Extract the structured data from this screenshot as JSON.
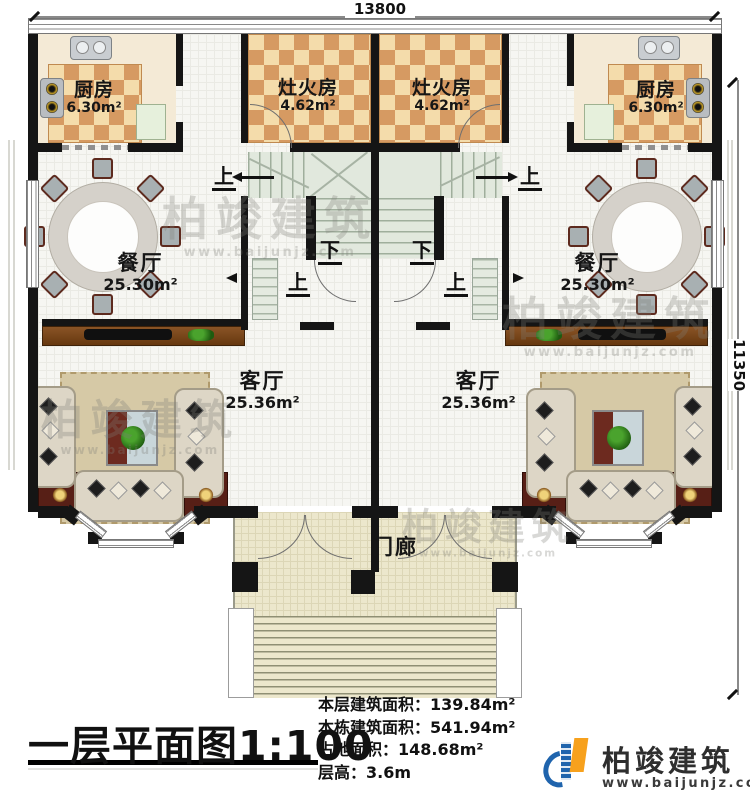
{
  "dimensions": {
    "top": "13800",
    "right": "11350"
  },
  "rooms": {
    "kitchen_left": {
      "name": "厨房",
      "area": "6.30m²"
    },
    "kitchen_right": {
      "name": "厨房",
      "area": "6.30m²"
    },
    "stove_room_left": {
      "name": "灶火房",
      "area": "4.62m²"
    },
    "stove_room_right": {
      "name": "灶火房",
      "area": "4.62m²"
    },
    "dining_left": {
      "name": "餐厅",
      "area": "25.30m²"
    },
    "dining_right": {
      "name": "餐厅",
      "area": "25.30m²"
    },
    "living_left": {
      "name": "客厅",
      "area": "25.36m²"
    },
    "living_right": {
      "name": "客厅",
      "area": "25.36m²"
    },
    "porch": {
      "name": "门廊"
    }
  },
  "stairs": {
    "up": "上",
    "down": "下"
  },
  "footer": {
    "title": "一层平面图",
    "scale": "1:100",
    "stats": [
      {
        "label": "本层建筑面积：",
        "value": "139.84m²"
      },
      {
        "label": "本栋建筑面积：",
        "value": "541.94m²"
      },
      {
        "label": "占地面积：",
        "value": "148.68m²"
      },
      {
        "label": "层高：",
        "value": "3.6m"
      }
    ]
  },
  "logo": {
    "name": "柏竣建筑",
    "url": "www.baijunjz.com"
  },
  "watermark": {
    "text": "柏竣建筑",
    "url": "www.baijunjz.com"
  },
  "colors": {
    "wall": "#151515",
    "checker_dark": "#d69a62",
    "checker_light": "#f4dcab",
    "stair_floor": "#e1e8dd",
    "porch_floor": "#ece7cc",
    "wood": "#7b4a26",
    "accent_red": "#571f16",
    "logo_blue": "#1f64ad",
    "logo_orange": "#f7a11d"
  }
}
